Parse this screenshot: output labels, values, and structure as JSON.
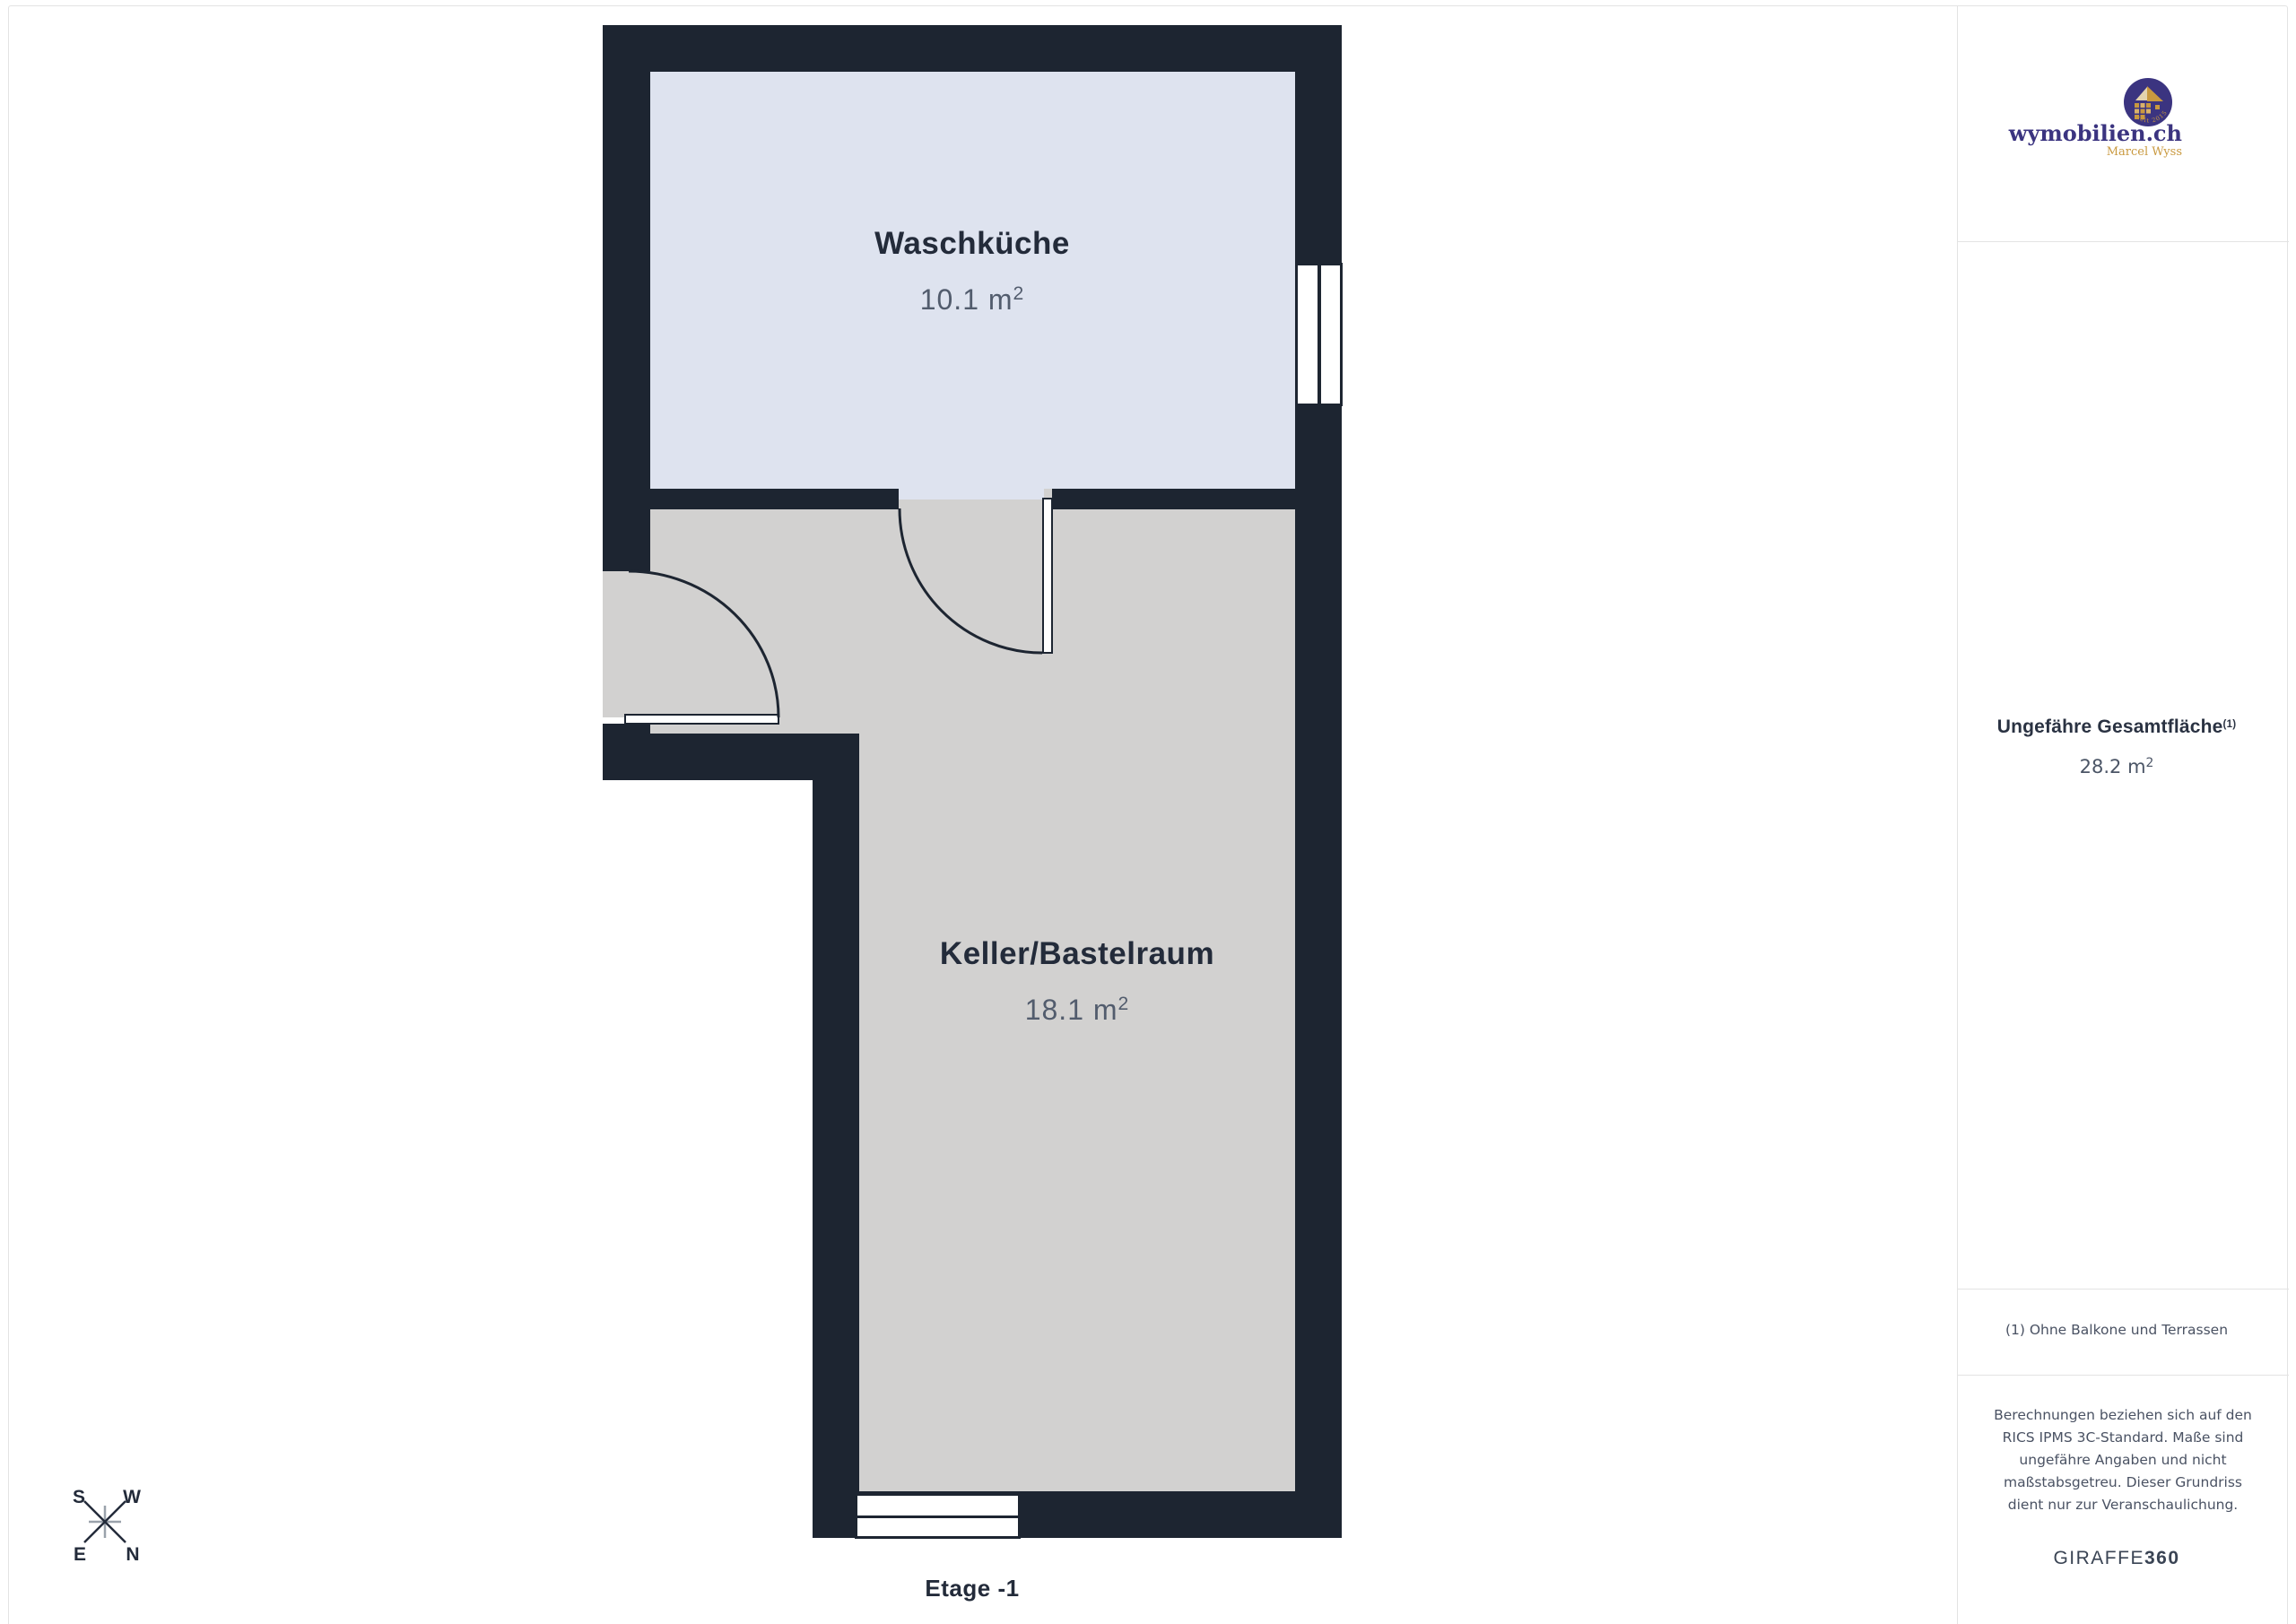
{
  "plan": {
    "floor_label": "Etage -1",
    "rooms": [
      {
        "name": "Waschküche",
        "area_value": "10.1",
        "area_unit": "m",
        "area_sup": "2"
      },
      {
        "name": "Keller/Bastelraum",
        "area_value": "18.1",
        "area_unit": "m",
        "area_sup": "2"
      }
    ]
  },
  "compass": {
    "top_left": "S",
    "top_right": "W",
    "bottom_left": "E",
    "bottom_right": "N"
  },
  "sidebar": {
    "logo": {
      "brand": "wymobilien.ch",
      "subtitle": "Marcel Wyss",
      "badge": "seit 2015"
    },
    "total_area": {
      "label": "Ungefähre Gesamtfläche",
      "footnote_ref": "(1)",
      "value": "28.2",
      "unit": "m",
      "unit_sup": "2"
    },
    "footnote": "(1) Ohne Balkone und Terrassen",
    "disclaimer_lines": [
      "Berechnungen beziehen sich auf den",
      "RICS IPMS 3C-Standard. Maße sind",
      "ungefähre Angaben und nicht",
      "maßstabsgetreu. Dieser Grundriss",
      "dient nur zur Veranschaulichung."
    ],
    "brand_footer_plain": "GIRAFFE",
    "brand_footer_bold": "360"
  },
  "colors": {
    "wall": "#1d2531",
    "waschkueche_fill": "#dee3ef",
    "keller_fill": "#d2d1d0",
    "text_dark": "#232b3a",
    "text_muted": "#525c6d",
    "logo_navy": "#3b3480",
    "logo_gold": "#c9993f",
    "divider": "#e3e3e3"
  }
}
